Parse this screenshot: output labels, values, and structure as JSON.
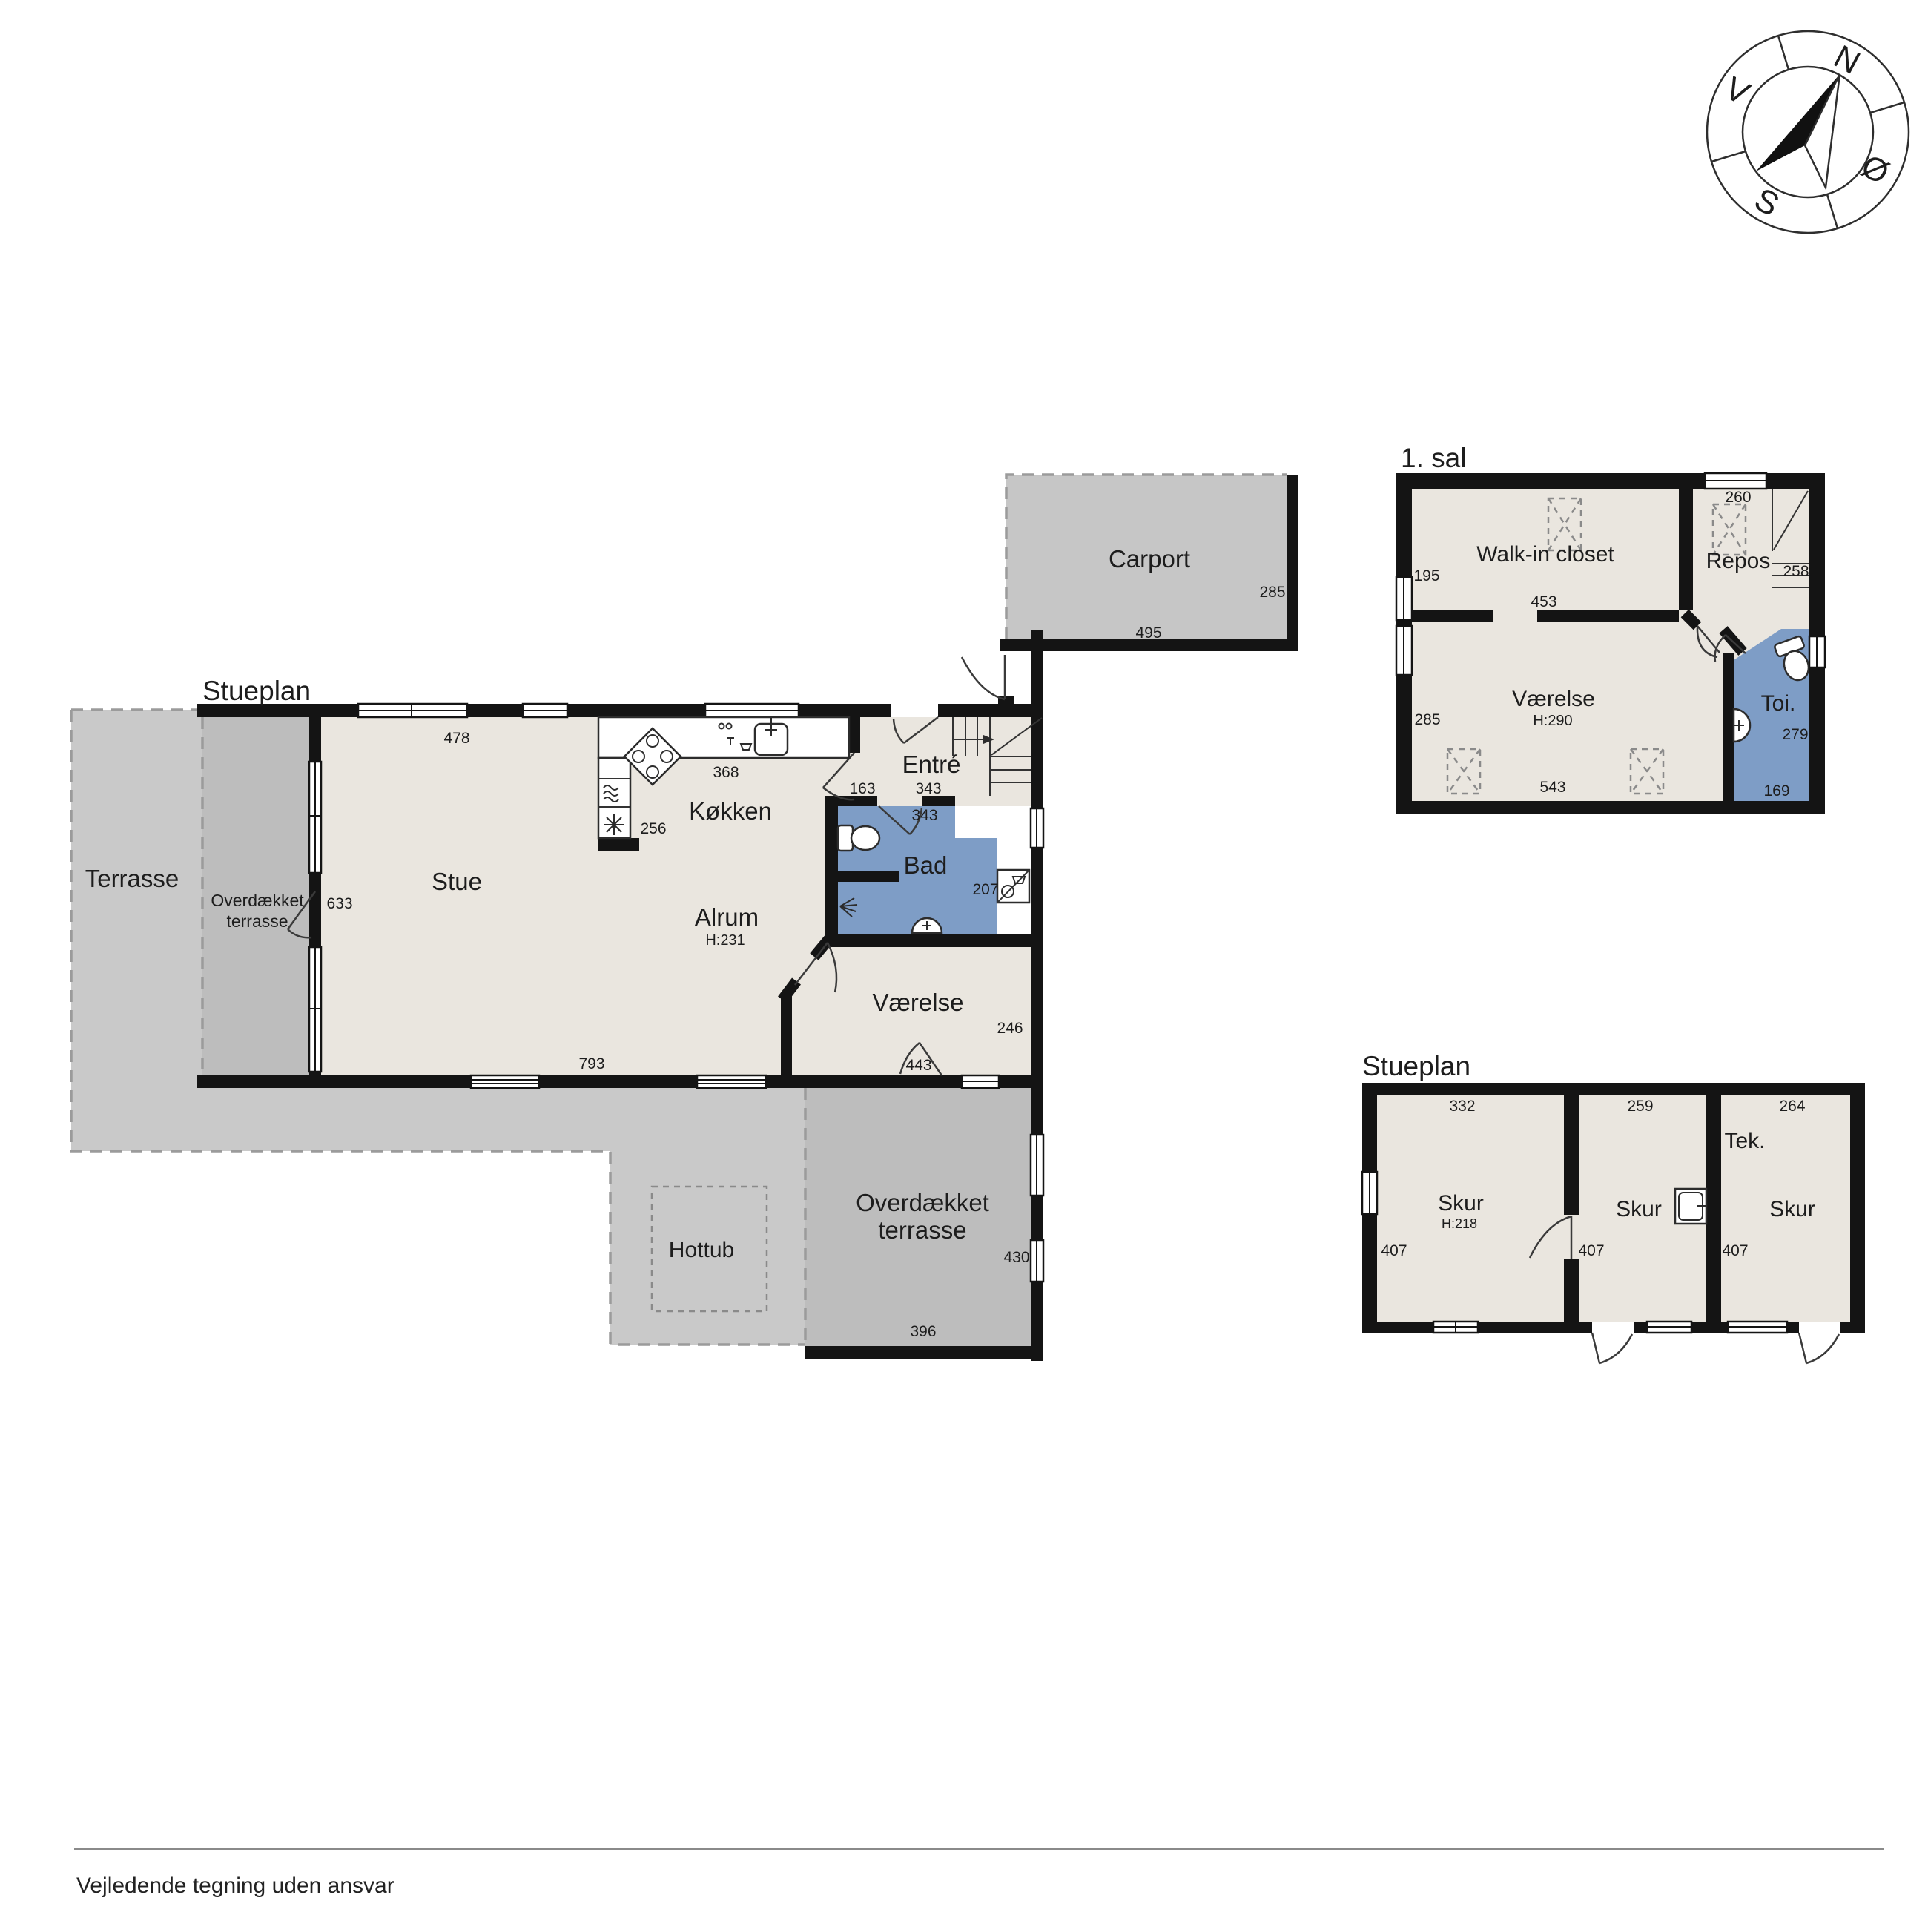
{
  "footer": {
    "disclaimer": "Vejledende tegning uden ansvar"
  },
  "compass": {
    "north": "N",
    "east": "Ø",
    "south": "S",
    "west": "V"
  },
  "colors": {
    "bathroom_blue": "#7E9DC6",
    "floor_beige": "#EAE6DF",
    "terrace_gray": "#C9C9C9",
    "covered_terrace_gray": "#BDBDBD",
    "carport_gray": "#C6C6C6",
    "wall_black": "#141414"
  },
  "ground_floor": {
    "title": "Stueplan",
    "rooms": {
      "terrasse": {
        "label": "Terrasse"
      },
      "overdaekket_vest": {
        "line1": "Overdækket",
        "line2": "terrasse"
      },
      "stue": {
        "label": "Stue"
      },
      "koekken": {
        "label": "Køkken",
        "width": "368",
        "depth": "256"
      },
      "alrum": {
        "label": "Alrum",
        "height": "H:231"
      },
      "entre": {
        "label": "Entré",
        "dim_a": "163",
        "dim_b": "343"
      },
      "bad": {
        "label": "Bad",
        "width": "343",
        "depth": "207"
      },
      "vaerelse": {
        "label": "Værelse",
        "width": "443",
        "depth": "246"
      },
      "hottub": {
        "label": "Hottub"
      },
      "overdaekket_syd": {
        "line1": "Overdækket",
        "line2": "terrasse",
        "depth": "430",
        "width": "396"
      },
      "carport": {
        "label": "Carport",
        "depth": "285",
        "width": "495"
      }
    },
    "dims": {
      "stue_top": "478",
      "stue_door": "633",
      "bottom": "793"
    }
  },
  "first_floor": {
    "title": "1. sal",
    "rooms": {
      "walk_in": {
        "label": "Walk-in closet",
        "dim_left": "195",
        "dim_width": "453"
      },
      "repos": {
        "label": "Repos",
        "dim_top": "260",
        "dim_right": "258"
      },
      "vaerelse": {
        "label": "Værelse",
        "height": "H:290",
        "dim_left": "285",
        "dim_width": "543"
      },
      "toi": {
        "label": "Toi.",
        "dim_right": "279",
        "dim_width": "169"
      }
    }
  },
  "outbuilding": {
    "title": "Stueplan",
    "rooms": {
      "skur_a": {
        "label": "Skur",
        "height": "H:218",
        "dim_top": "332",
        "dim_left": "407"
      },
      "skur_b": {
        "label": "Skur",
        "dim_top": "259",
        "dim_left": "407"
      },
      "skur_c": {
        "label": "Skur",
        "dim_top": "264",
        "dim_left": "407"
      },
      "tek": {
        "label": "Tek."
      }
    }
  }
}
